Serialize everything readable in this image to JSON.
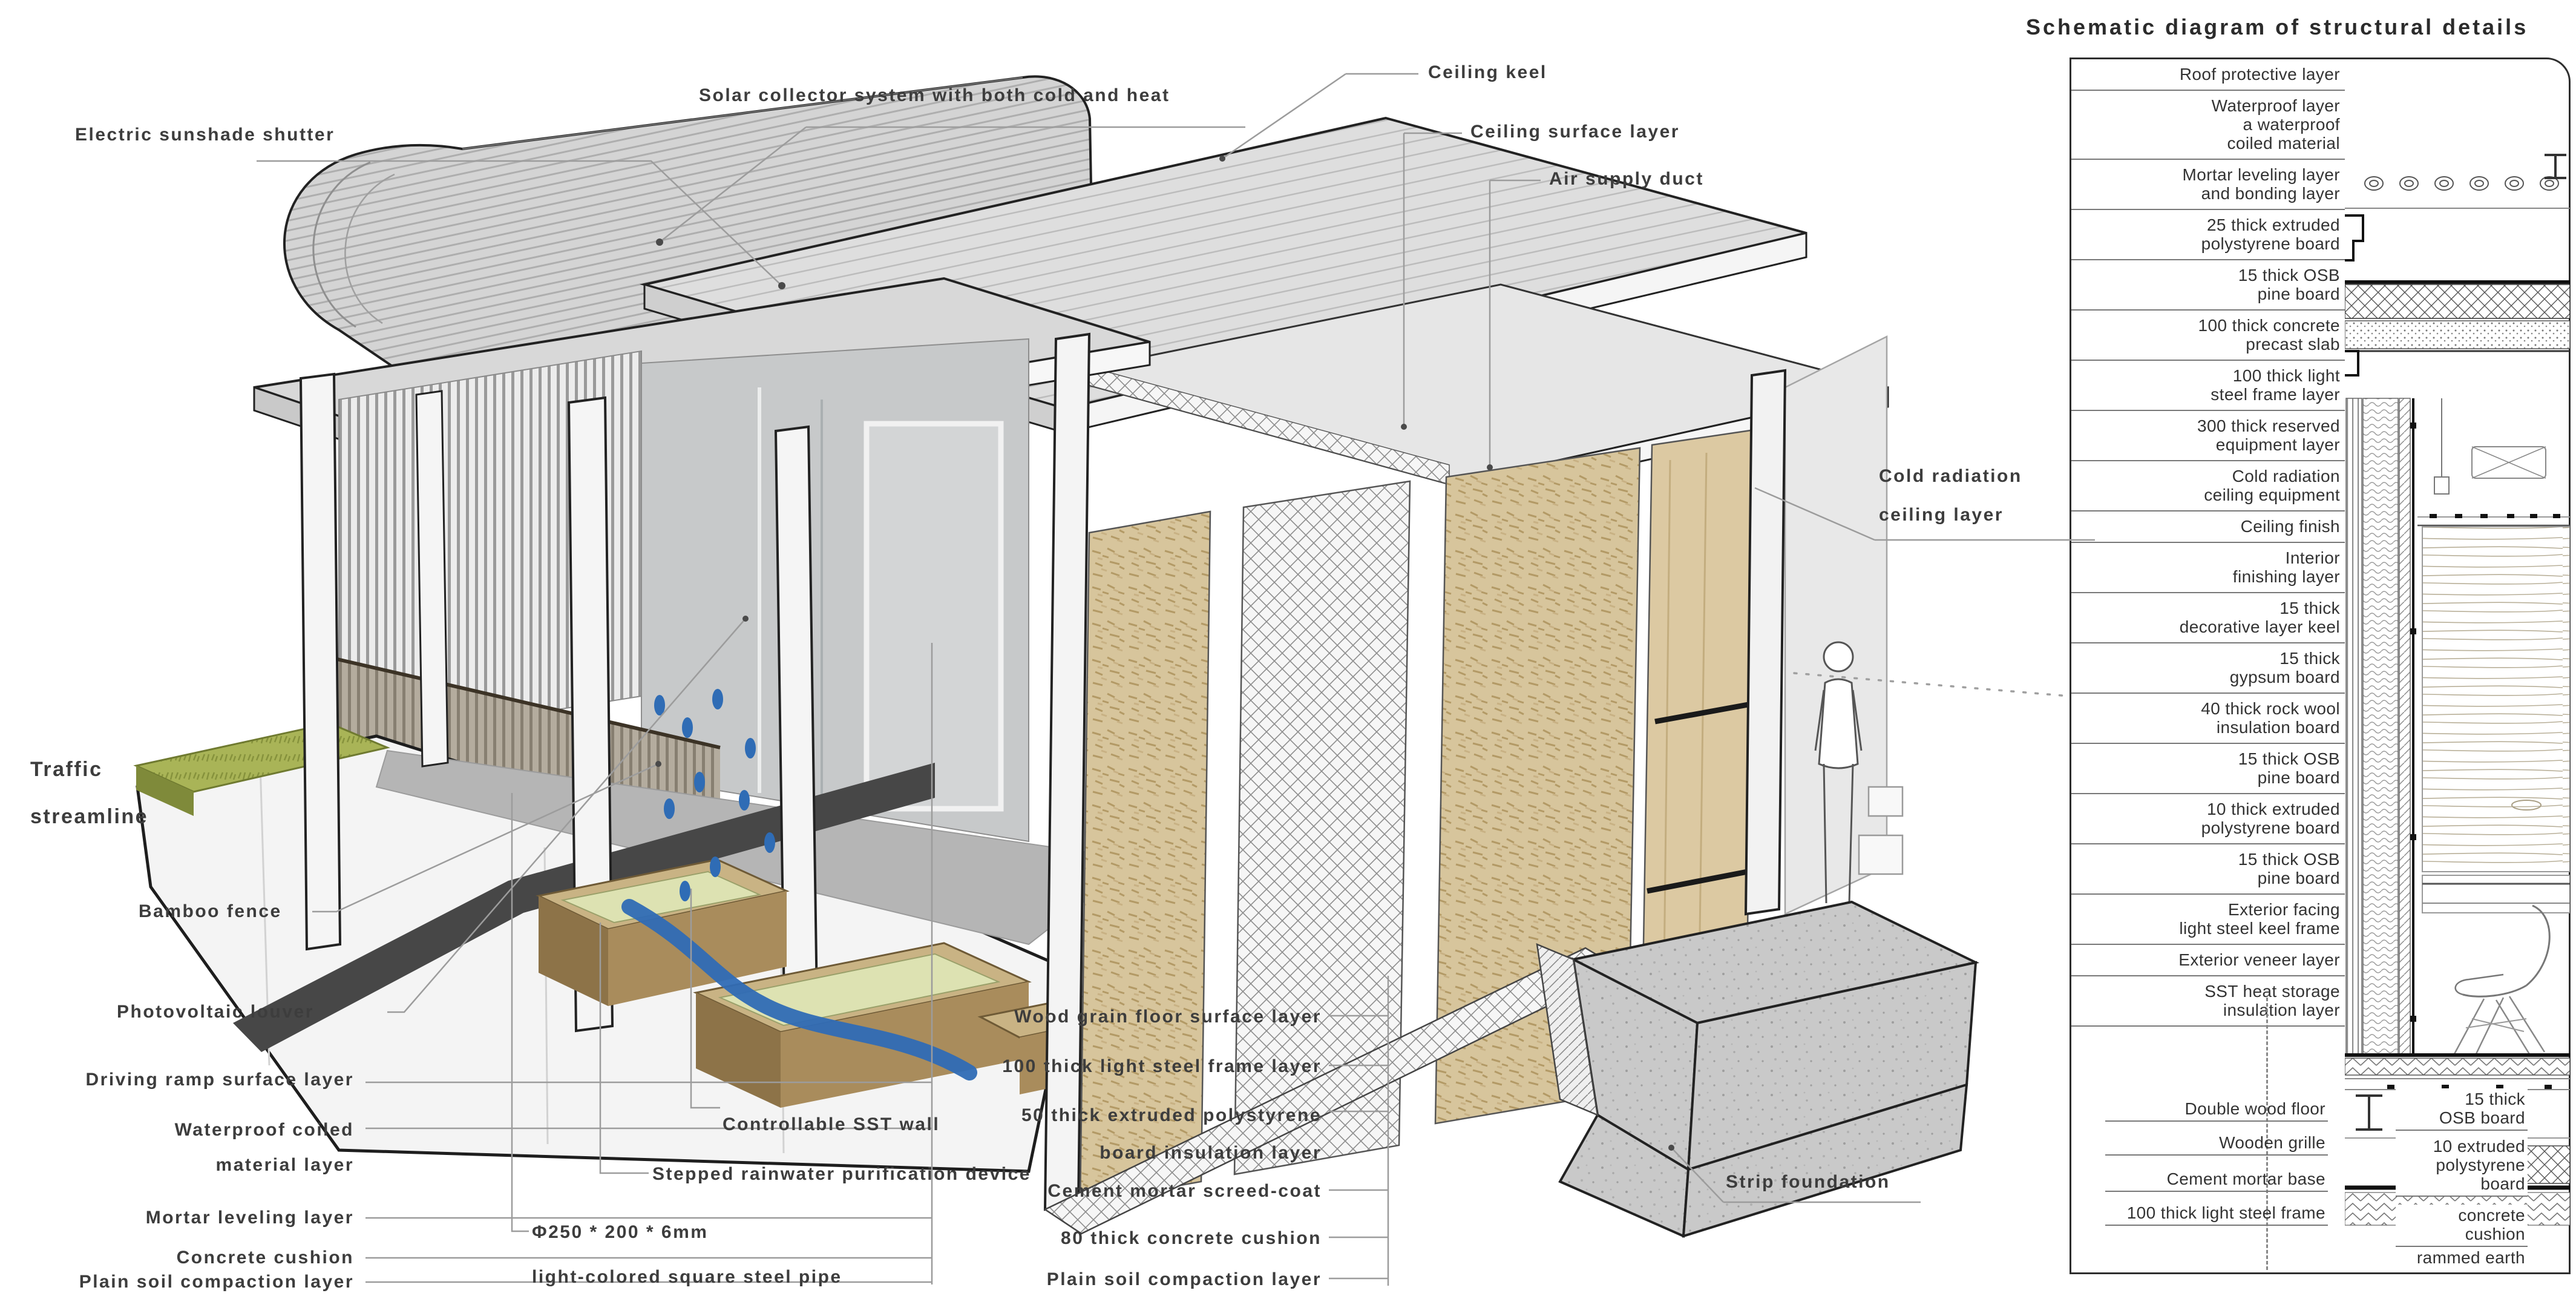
{
  "panel": {
    "title": "Schematic diagram of structural details",
    "layers": [
      "Roof protective layer",
      "Waterproof layer\na waterproof\ncoiled material",
      "Mortar leveling layer\nand bonding layer",
      "25 thick extruded\npolystyrene board",
      "15 thick OSB\npine board",
      "100 thick concrete\nprecast slab",
      "100 thick light\nsteel frame layer",
      "300 thick reserved\nequipment layer",
      "Cold radiation\nceiling equipment",
      "Ceiling finish",
      "Interior\nfinishing layer",
      "15 thick\ndecorative layer keel",
      "15 thick\ngypsum board",
      "40 thick rock wool\ninsulation board",
      "15 thick OSB\npine board",
      "10 thick extruded\npolystyrene board",
      "15 thick OSB\npine board",
      "Exterior facing\nlight steel keel frame",
      "Exterior veneer layer",
      "SST heat storage\ninsulation layer"
    ],
    "bottom_left": [
      "Double wood floor",
      "Wooden grille",
      "Cement mortar base",
      "100 thick light steel frame"
    ],
    "bottom_right": [
      "15 thick\nOSB board",
      "10 extruded\npolystyrene\nboard",
      "concrete\ncushion",
      "rammed earth"
    ]
  },
  "callouts": {
    "electric_sunshade_shutter": "Electric sunshade shutter",
    "solar_collector": "Solar collector system with both cold and heat",
    "ceiling_keel": "Ceiling keel",
    "ceiling_surface_layer": "Ceiling surface layer",
    "air_supply_duct": "Air supply duct",
    "cold_radiation_ceiling": "Cold radiation\nceiling layer",
    "traffic_streamline": "Traffic\nstreamline",
    "bamboo_fence": "Bamboo fence",
    "photovoltaic_louver": "Photovoltaic louver",
    "driving_ramp": "Driving ramp surface layer",
    "waterproof_coiled": "Waterproof coiled\nmaterial layer",
    "mortar_leveling": "Mortar leveling layer",
    "concrete_cushion": "Concrete cushion",
    "plain_soil_left": "Plain soil compaction layer",
    "controllable_sst_wall": "Controllable SST wall",
    "stepped_rainwater": "Stepped rainwater purification device",
    "pipe_spec": "Φ250 * 200 * 6mm",
    "pipe_desc": "light-colored square steel pipe",
    "wood_grain_floor": "Wood grain floor surface layer",
    "steel_frame_100": "100 thick light steel frame layer",
    "polystyrene_50": "50 thick extruded polystyrene\nboard insulation layer",
    "cement_screed": "Cement mortar screed-coat",
    "concrete_cushion_80": "80 thick concrete cushion",
    "plain_soil_right": "Plain soil compaction layer",
    "strip_foundation": "Strip foundation"
  },
  "colors": {
    "label_text": "#3d3d3d",
    "leader_line": "#9c9c9c",
    "water_blue": "#2f6cb5",
    "wood_tan": "#c9b384",
    "osb": "#d7c59c",
    "grass_green": "#a9b457",
    "ramp_gray": "#474747",
    "concrete": "#c6c6c6"
  }
}
